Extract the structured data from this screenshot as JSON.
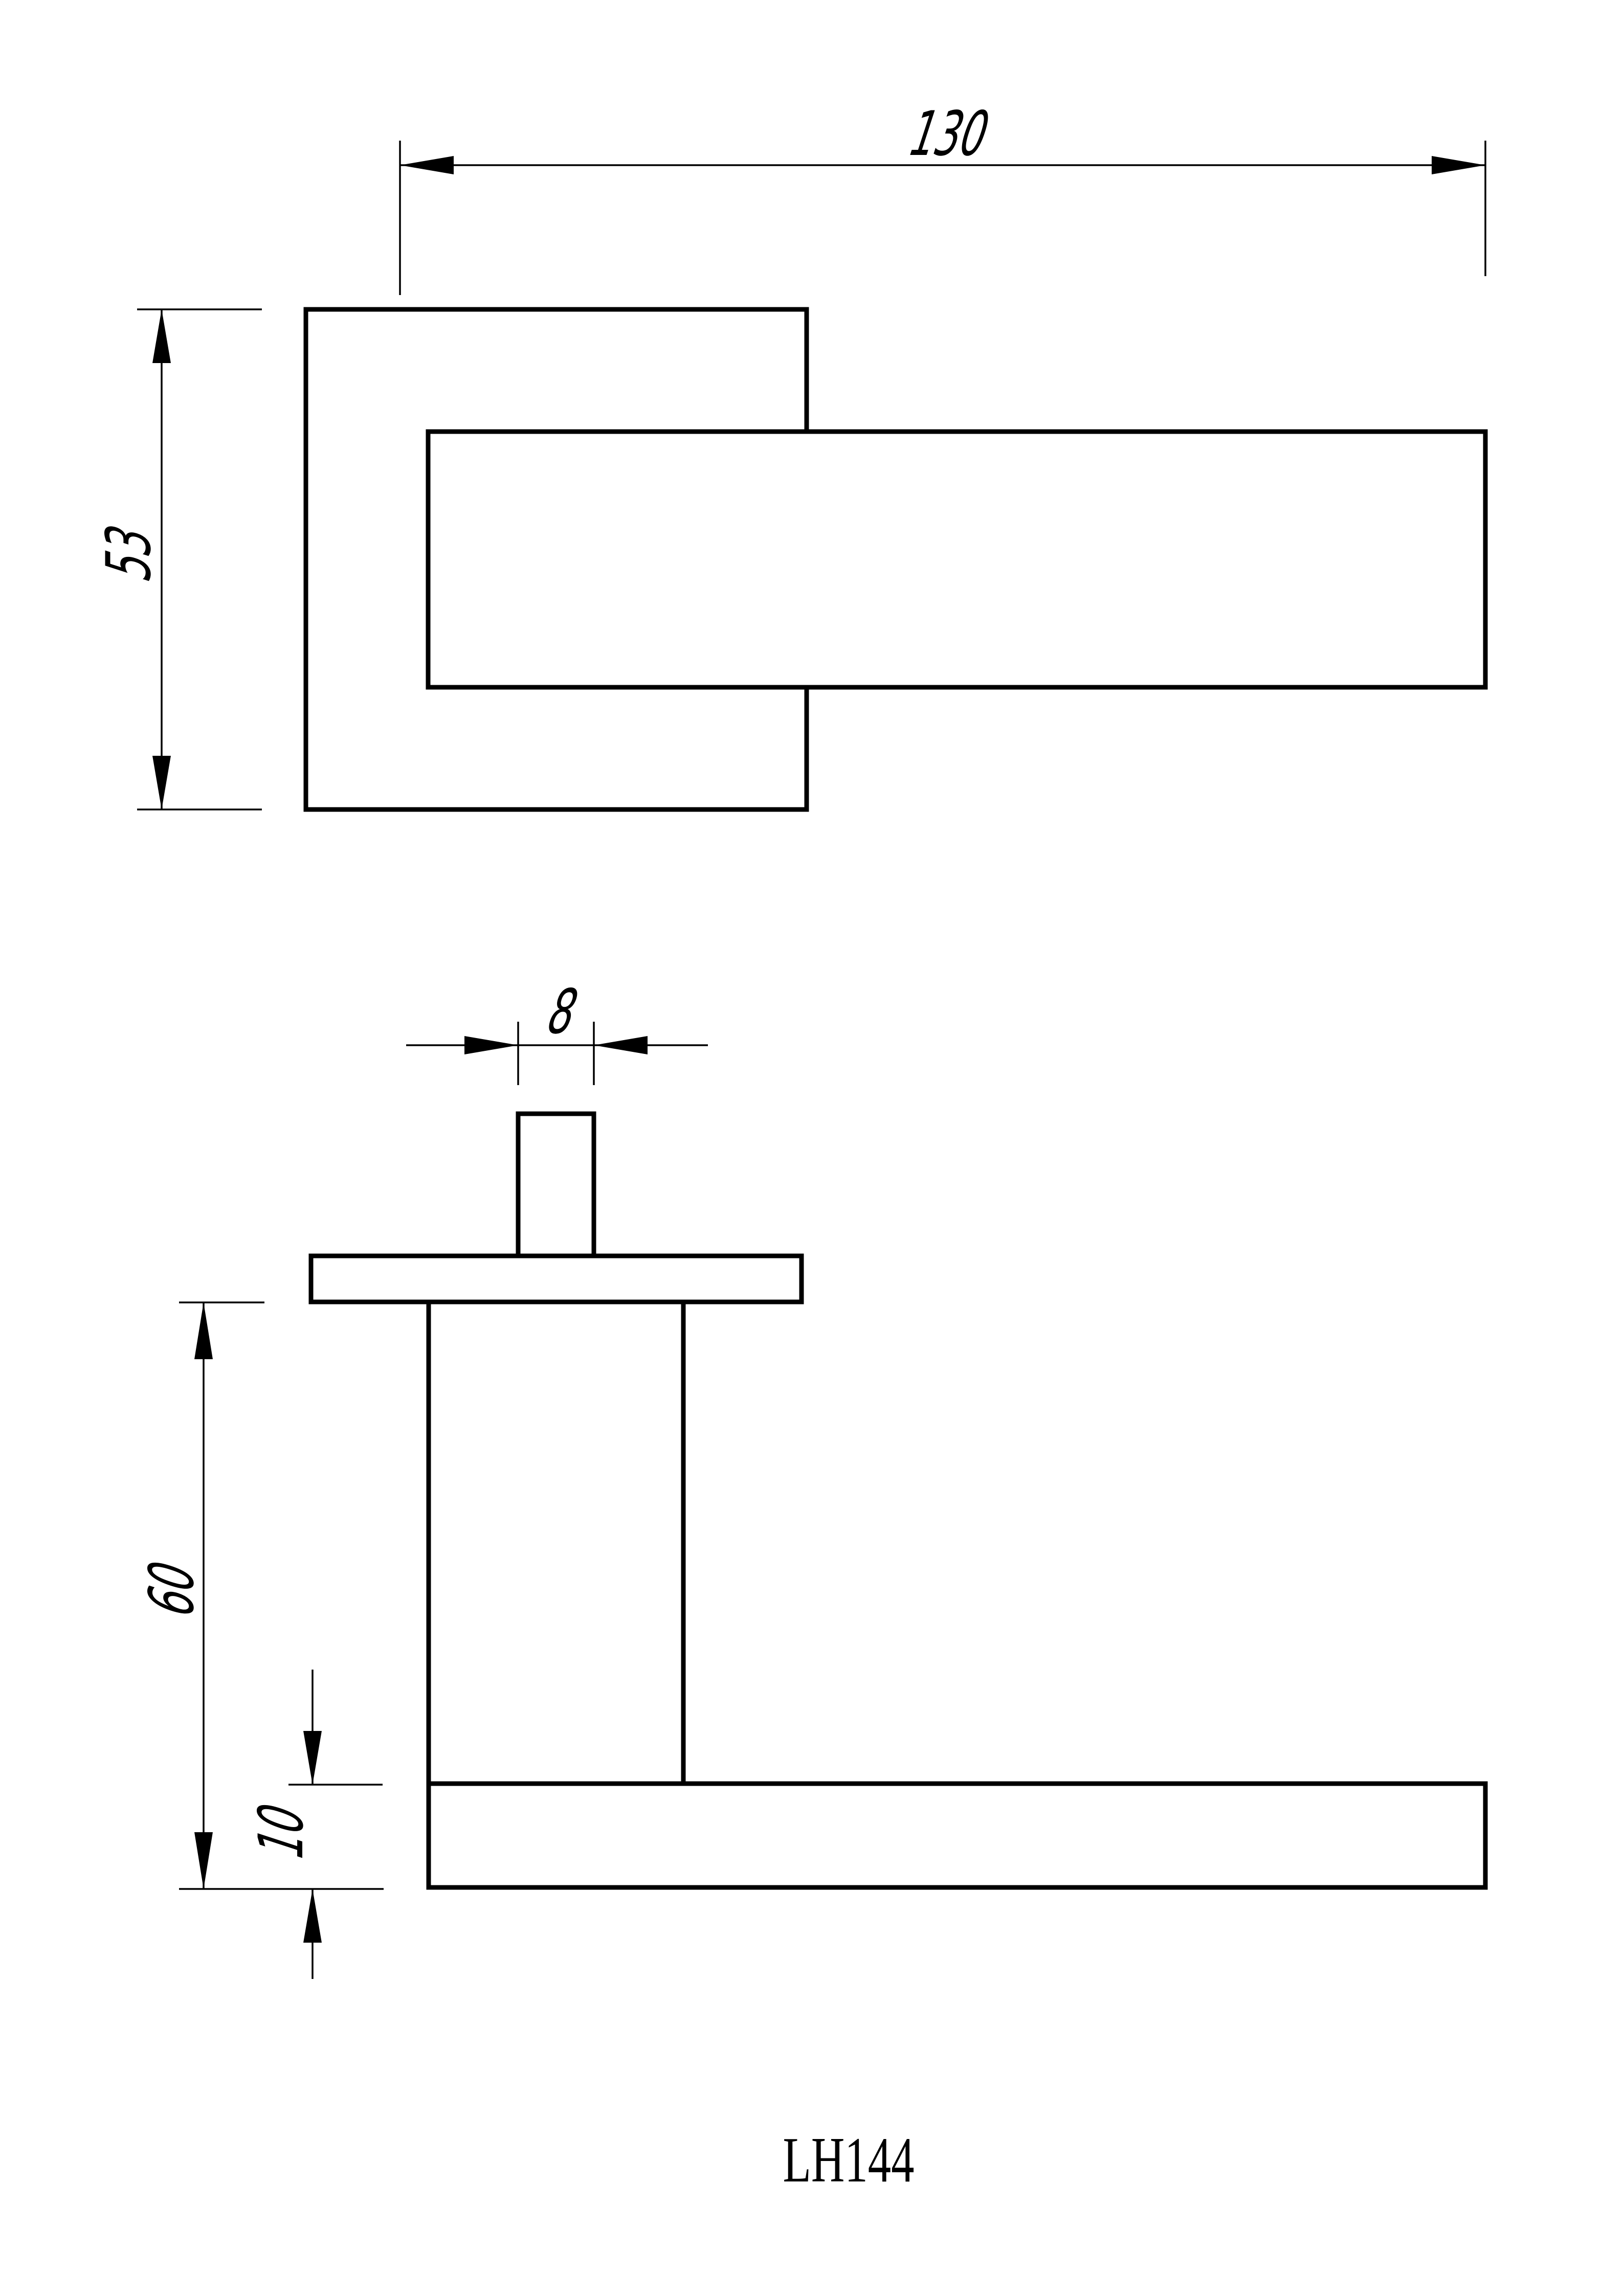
{
  "page": {
    "background": "#ffffff"
  },
  "drawing": {
    "product_code": "LH144",
    "line_color": "#000000",
    "dimensions": {
      "front_length": "130",
      "front_height": "53",
      "spindle_width": "8",
      "side_height": "60",
      "lever_thickness": "10"
    }
  }
}
